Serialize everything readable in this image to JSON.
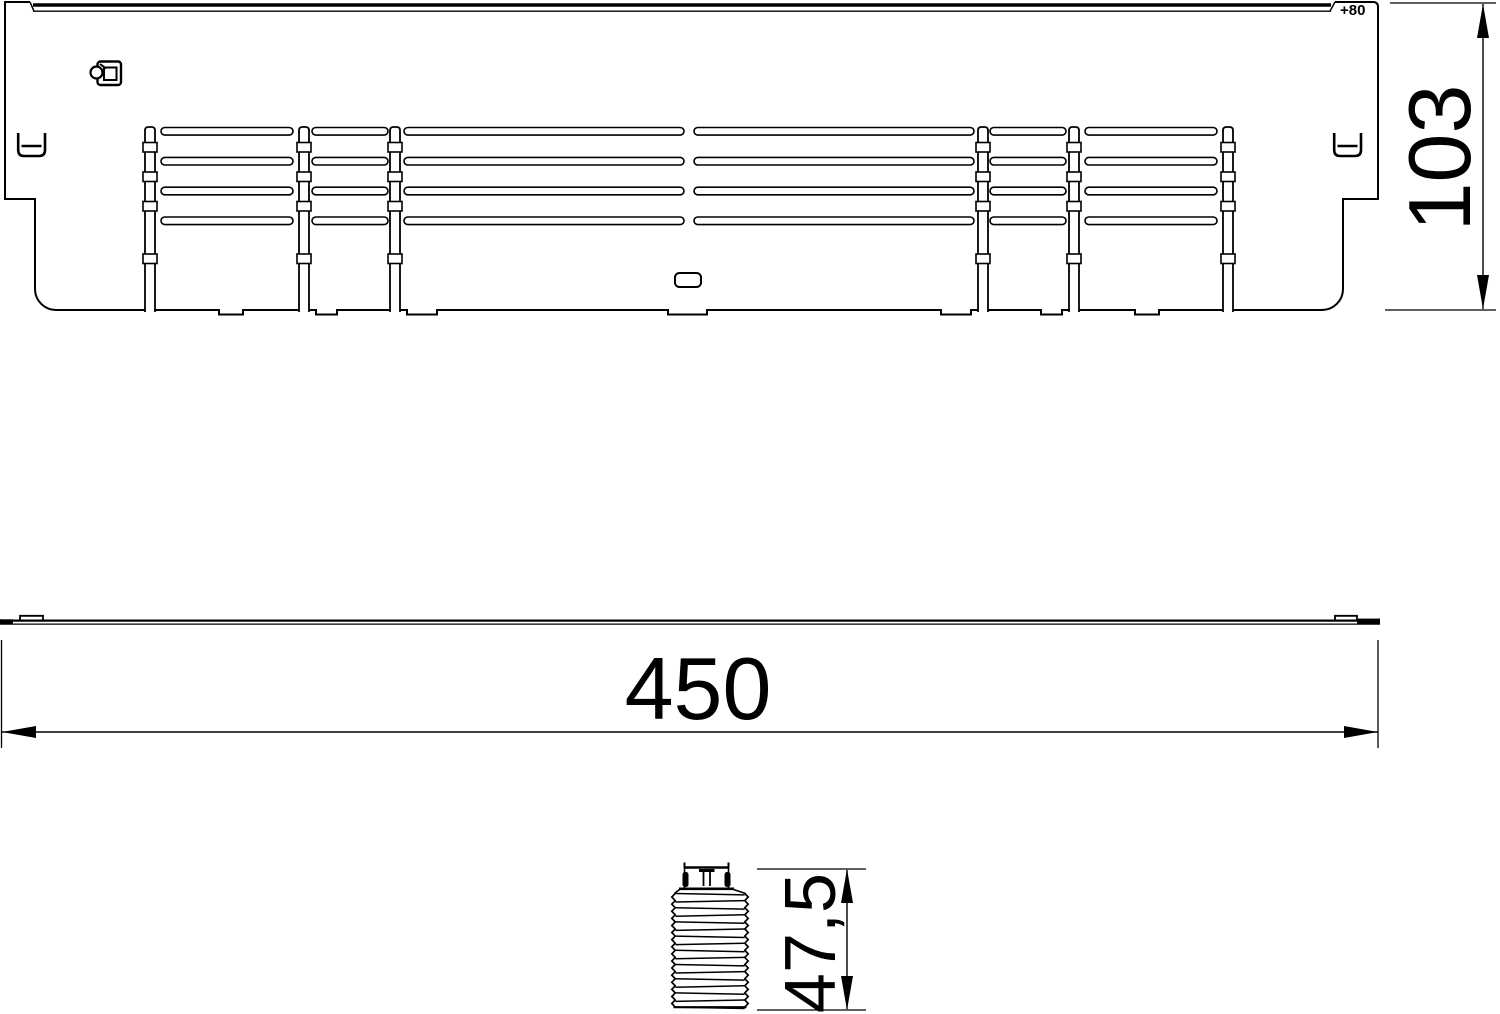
{
  "drawing": {
    "top_view": {
      "offset_label": "+80"
    },
    "dimensions": {
      "overall_width": {
        "value": "450"
      },
      "overall_height": {
        "value": "103"
      },
      "screw_length": {
        "value": "47,5"
      }
    },
    "colors": {
      "line": "#000000",
      "background": "#ffffff"
    }
  }
}
